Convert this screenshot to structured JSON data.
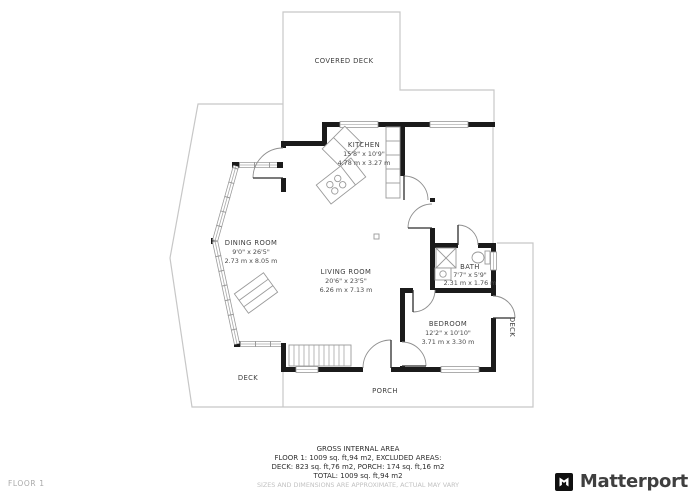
{
  "floor": {
    "label": "FLOOR 1"
  },
  "branding": {
    "logo_text": "Matterport"
  },
  "rooms": {
    "covered_deck": {
      "name": "COVERED DECK"
    },
    "kitchen": {
      "name": "KITCHEN",
      "dims_ft": "15'8\" x 10'9\"",
      "dims_m": "4.78 m x 3.27 m"
    },
    "dining_room": {
      "name": "DINING ROOM",
      "dims_ft": "9'0\" x 26'5\"",
      "dims_m": "2.73 m x 8.05 m"
    },
    "living_room": {
      "name": "LIVING ROOM",
      "dims_ft": "20'6\" x 23'5\"",
      "dims_m": "6.26 m x 7.13 m"
    },
    "bath": {
      "name": "BATH",
      "dims_ft": "7'7\" x 5'9\"",
      "dims_m": "2.31 m x 1.76 m"
    },
    "bedroom": {
      "name": "BEDROOM",
      "dims_ft": "12'2\" x 10'10\"",
      "dims_m": "3.71 m x 3.30 m"
    },
    "deck_left": {
      "name": "DECK"
    },
    "deck_right": {
      "name": "DECK"
    },
    "porch": {
      "name": "PORCH"
    }
  },
  "footer": {
    "title": "GROSS INTERNAL AREA",
    "line2": "FLOOR 1: 1009 sq. ft,94 m2, EXCLUDED AREAS:",
    "line3": "DECK: 823 sq. ft,76 m2, PORCH: 174 sq. ft,16 m2",
    "line4": "TOTAL: 1009 sq. ft,94 m2",
    "disclaimer": "SIZES AND DIMENSIONS ARE APPROXIMATE, ACTUAL MAY VARY"
  },
  "colors": {
    "wall": "#1b1b1b",
    "deck_outline": "#c7c7c7",
    "fixture": "#9a9a9a",
    "window_edge": "#999999",
    "label": "#3d3d3d",
    "muted": "#c2c2c2"
  }
}
